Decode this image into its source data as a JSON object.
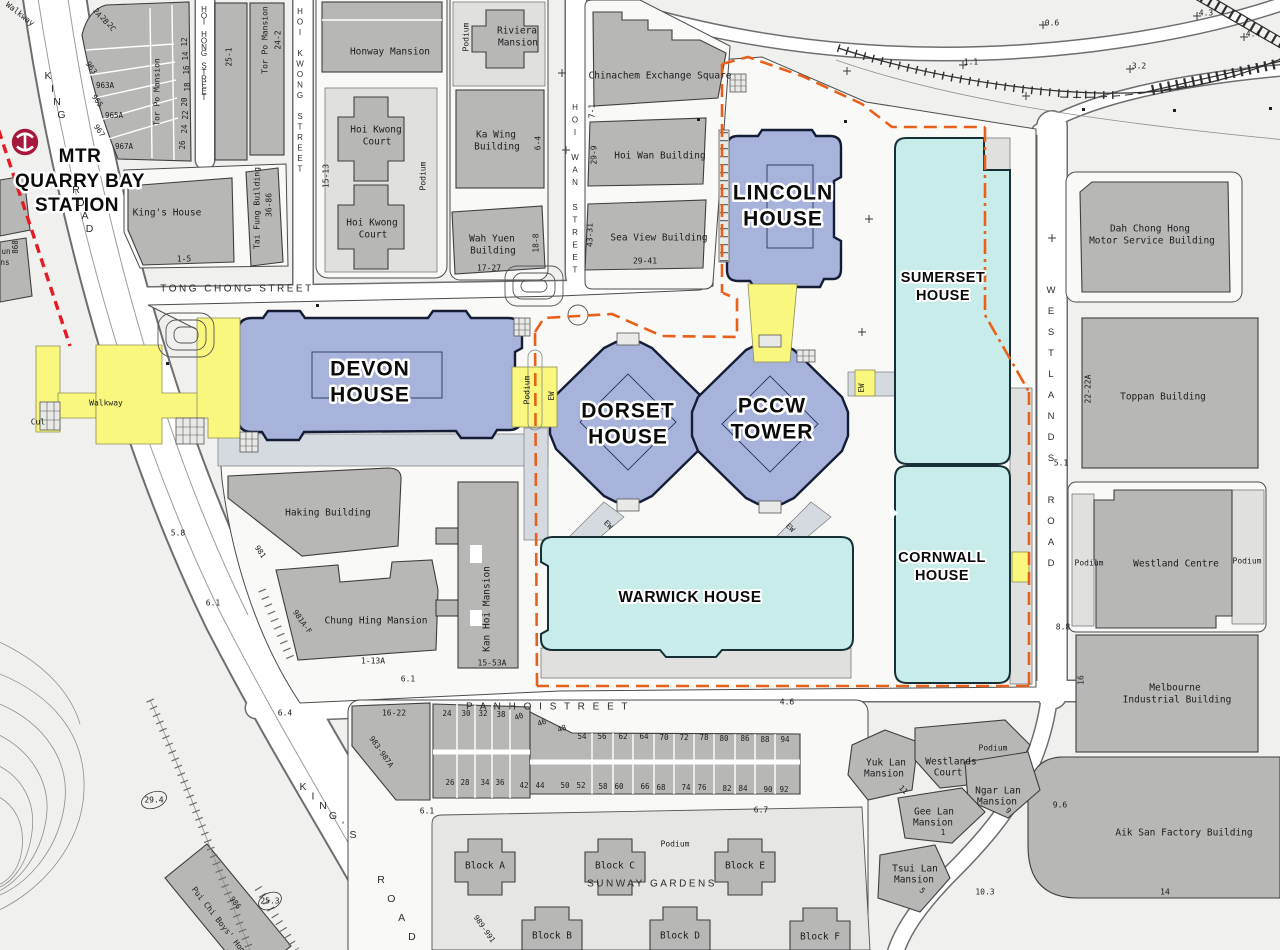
{
  "station": {
    "name": "MTR QUARRY BAY STATION",
    "logo": "mtr-logo"
  },
  "colors": {
    "office_blue": "#a7b3da",
    "tech_cyan": "#c7ecea",
    "walkway_yellow": "#f9f77d",
    "boundary_orange": "#e8611c",
    "mtr_red": "#e31b23",
    "mtr_logo": "#a6173c",
    "building_grey": "#b7b8b6"
  },
  "labels": {
    "station": [
      {
        "t": "MTR",
        "x": 80,
        "y": 157,
        "c": "station"
      },
      {
        "t": "QUARRY BAY",
        "x": 80,
        "y": 182,
        "c": "station"
      },
      {
        "t": "STATION",
        "x": 77,
        "y": 206,
        "c": "station"
      }
    ],
    "major_buildings": [
      {
        "t": "DEVON",
        "x": 370,
        "y": 370,
        "c": "halo1"
      },
      {
        "t": "HOUSE",
        "x": 370,
        "y": 396,
        "c": "halo1"
      },
      {
        "t": "DORSET",
        "x": 628,
        "y": 412,
        "c": "halo1"
      },
      {
        "t": "HOUSE",
        "x": 628,
        "y": 438,
        "c": "halo1"
      },
      {
        "t": "PCCW",
        "x": 772,
        "y": 407,
        "c": "halo1"
      },
      {
        "t": "TOWER",
        "x": 772,
        "y": 433,
        "c": "halo1"
      },
      {
        "t": "LINCOLN",
        "x": 783,
        "y": 194,
        "c": "halo1"
      },
      {
        "t": "HOUSE",
        "x": 783,
        "y": 220,
        "c": "halo1"
      },
      {
        "t": "SUMERSET",
        "x": 943,
        "y": 278,
        "c": "halo2"
      },
      {
        "t": "HOUSE",
        "x": 943,
        "y": 296,
        "c": "halo2"
      },
      {
        "t": "CORNWALL",
        "x": 942,
        "y": 558,
        "c": "halo2"
      },
      {
        "t": "HOUSE",
        "x": 942,
        "y": 576,
        "c": "halo2"
      },
      {
        "t": "WARWICK HOUSE",
        "x": 690,
        "y": 598,
        "c": "halo3"
      }
    ],
    "streets": [
      {
        "t": "TONG  CHONG  STREET",
        "x": 237,
        "y": 289,
        "c": "street"
      },
      {
        "t": "P A N    H O I    S T R E E T",
        "x": 548,
        "y": 707,
        "c": "street"
      },
      {
        "t": "SUNWAY  GARDENS",
        "x": 652,
        "y": 884,
        "c": "street"
      },
      {
        "t": "HOI HONG STREET",
        "x": 204,
        "y": 10,
        "c": "streetv",
        "v": 1,
        "lh": 6.3
      },
      {
        "t": "HOI KWONG STREET",
        "x": 300,
        "y": 12,
        "c": "streetv",
        "v": 1,
        "lh": 10.5
      },
      {
        "t": "HOI WAN STREET",
        "x": 575,
        "y": 108,
        "c": "streetv",
        "v": 1,
        "lh": 12.5
      },
      {
        "t": "WESTLANDS ROAD",
        "x": 1051,
        "y": 290,
        "c": "streetv2",
        "v": 1,
        "lh": 21
      },
      {
        "t": "KING",
        "x": 48,
        "y": 76,
        "c": "kings",
        "v": 1,
        "lh": 13,
        "sx": 4.5
      },
      {
        "t": "ROAD",
        "x": 76,
        "y": 190,
        "c": "kings",
        "v": 1,
        "lh": 13,
        "sx": 4.5
      },
      {
        "t": "KING'S",
        "x": 303,
        "y": 787,
        "c": "kings",
        "v": 1,
        "lh": 9.6,
        "sx": 10
      },
      {
        "t": "ROAD",
        "x": 381,
        "y": 880,
        "c": "kings",
        "v": 1,
        "lh": 19,
        "sx": 10.3
      }
    ],
    "buildings": [
      {
        "t": "Honway Mansion",
        "x": 390,
        "y": 52
      },
      {
        "t": "Riviera",
        "x": 517,
        "y": 31
      },
      {
        "t": "Mansion",
        "x": 518,
        "y": 43
      },
      {
        "t": "Podium",
        "x": 466,
        "y": 37,
        "r": -90,
        "c": "cadsm"
      },
      {
        "t": "Hoi Kwong",
        "x": 376,
        "y": 130
      },
      {
        "t": "Court",
        "x": 377,
        "y": 142
      },
      {
        "t": "Hoi Kwong",
        "x": 372,
        "y": 223
      },
      {
        "t": "Court",
        "x": 373,
        "y": 235
      },
      {
        "t": "15-13",
        "x": 326,
        "y": 176,
        "r": -90,
        "c": "cadsm"
      },
      {
        "t": "Podium",
        "x": 423,
        "y": 176,
        "r": -90,
        "c": "cadsm"
      },
      {
        "t": "Ka Wing",
        "x": 496,
        "y": 135
      },
      {
        "t": "Building",
        "x": 497,
        "y": 147
      },
      {
        "t": "6-4",
        "x": 538,
        "y": 143,
        "r": -90,
        "c": "cadsm"
      },
      {
        "t": "Wah Yuen",
        "x": 492,
        "y": 239
      },
      {
        "t": "Building",
        "x": 493,
        "y": 251
      },
      {
        "t": "17-27",
        "x": 489,
        "y": 268,
        "c": "cadsm"
      },
      {
        "t": "18-8",
        "x": 536,
        "y": 243,
        "r": -90,
        "c": "cadsm"
      },
      {
        "t": "Chinachem Exchange Square",
        "x": 660,
        "y": 76
      },
      {
        "t": "7-1",
        "x": 592,
        "y": 111,
        "r": -90,
        "c": "cadsm"
      },
      {
        "t": "Hoi Wan Building",
        "x": 660,
        "y": 156
      },
      {
        "t": "29-9",
        "x": 594,
        "y": 155,
        "r": -90,
        "c": "cadsm"
      },
      {
        "t": "Sea View Building",
        "x": 659,
        "y": 238
      },
      {
        "t": "29-41",
        "x": 645,
        "y": 261,
        "c": "cadsm"
      },
      {
        "t": "43-31",
        "x": 590,
        "y": 235,
        "r": -90,
        "c": "cadsm"
      },
      {
        "t": "Tor Po Mansion",
        "x": 157,
        "y": 92,
        "r": -90,
        "c": "cadsm"
      },
      {
        "t": "Tor Po Mansion",
        "x": 265,
        "y": 40,
        "r": -90,
        "c": "cadsm"
      },
      {
        "t": "24-2",
        "x": 278,
        "y": 40,
        "r": -90,
        "c": "cadsm"
      },
      {
        "t": "25-1",
        "x": 229,
        "y": 57,
        "r": -90,
        "c": "cadsm"
      },
      {
        "t": "King's House",
        "x": 167,
        "y": 213
      },
      {
        "t": "1-5",
        "x": 184,
        "y": 259,
        "c": "cadsm"
      },
      {
        "t": "Tai Fung Building",
        "x": 257,
        "y": 208,
        "r": -90,
        "c": "cadsm"
      },
      {
        "t": "36-86",
        "x": 269,
        "y": 205,
        "r": -90,
        "c": "cadsm"
      },
      {
        "t": "963",
        "x": 91,
        "y": 68,
        "r": 55,
        "c": "num"
      },
      {
        "t": "963A",
        "x": 105,
        "y": 86,
        "c": "num"
      },
      {
        "t": "965",
        "x": 97,
        "y": 101,
        "r": 55,
        "c": "num"
      },
      {
        "t": "965A",
        "x": 114,
        "y": 116,
        "c": "num"
      },
      {
        "t": "967",
        "x": 99,
        "y": 131,
        "r": 55,
        "c": "num"
      },
      {
        "t": "967A",
        "x": 124,
        "y": 147,
        "c": "num"
      },
      {
        "t": "2A",
        "x": 97,
        "y": 13,
        "r": 55,
        "c": "num"
      },
      {
        "t": "2B",
        "x": 104,
        "y": 20,
        "r": 55,
        "c": "num"
      },
      {
        "t": "2C",
        "x": 111,
        "y": 27,
        "r": 55,
        "c": "num"
      },
      {
        "t": "12",
        "x": 185,
        "y": 42,
        "r": -90,
        "c": "num"
      },
      {
        "t": "14",
        "x": 186,
        "y": 56,
        "r": -90,
        "c": "num"
      },
      {
        "t": "16",
        "x": 187,
        "y": 70,
        "r": -90,
        "c": "num"
      },
      {
        "t": "18",
        "x": 188,
        "y": 87,
        "r": -90,
        "c": "num"
      },
      {
        "t": "20",
        "x": 185,
        "y": 102,
        "r": -90,
        "c": "num"
      },
      {
        "t": "22",
        "x": 186,
        "y": 115,
        "r": -90,
        "c": "num"
      },
      {
        "t": "24",
        "x": 185,
        "y": 129,
        "r": -90,
        "c": "num"
      },
      {
        "t": "26",
        "x": 183,
        "y": 145,
        "r": -90,
        "c": "num"
      },
      {
        "t": "868",
        "x": 16,
        "y": 247,
        "r": -90,
        "c": "num"
      },
      {
        "t": "un",
        "x": 6,
        "y": 252,
        "c": "num"
      },
      {
        "t": "ns",
        "x": 5,
        "y": 263,
        "c": "num"
      },
      {
        "t": "Dah Chong Hong",
        "x": 1150,
        "y": 229
      },
      {
        "t": "Motor Service Building",
        "x": 1152,
        "y": 241
      },
      {
        "t": "Toppan Building",
        "x": 1163,
        "y": 397
      },
      {
        "t": "22-22A",
        "x": 1088,
        "y": 389,
        "r": -90,
        "c": "cadsm"
      },
      {
        "t": "Westland Centre",
        "x": 1176,
        "y": 564
      },
      {
        "t": "Podium",
        "x": 1089,
        "y": 563,
        "c": "cadsm"
      },
      {
        "t": "Podium",
        "x": 1247,
        "y": 561,
        "c": "cadsm"
      },
      {
        "t": "Melbourne",
        "x": 1175,
        "y": 688
      },
      {
        "t": "Industrial Building",
        "x": 1177,
        "y": 700
      },
      {
        "t": "16",
        "x": 1081,
        "y": 680,
        "r": -90,
        "c": "cadsm"
      },
      {
        "t": "Aik San Factory Building",
        "x": 1184,
        "y": 833
      },
      {
        "t": "14",
        "x": 1165,
        "y": 892,
        "c": "cadsm"
      },
      {
        "t": "Haking Building",
        "x": 328,
        "y": 513
      },
      {
        "t": "981",
        "x": 260,
        "y": 552,
        "r": 55,
        "c": "num"
      },
      {
        "t": "Chung Hing Mansion",
        "x": 376,
        "y": 621
      },
      {
        "t": "981A-F",
        "x": 302,
        "y": 622,
        "r": 55,
        "c": "num"
      },
      {
        "t": "1-13A",
        "x": 373,
        "y": 661,
        "c": "cadsm"
      },
      {
        "t": "Kan Hoi Mansion",
        "x": 487,
        "y": 609,
        "r": -90
      },
      {
        "t": "15-53A",
        "x": 492,
        "y": 663,
        "c": "cadsm"
      },
      {
        "t": "Yuk Lan",
        "x": 886,
        "y": 763
      },
      {
        "t": "Mansion",
        "x": 884,
        "y": 774
      },
      {
        "t": "Westlands",
        "x": 951,
        "y": 762
      },
      {
        "t": "Court",
        "x": 948,
        "y": 773
      },
      {
        "t": "Podium",
        "x": 993,
        "y": 748,
        "c": "cadsm"
      },
      {
        "t": "Ngar Lan",
        "x": 998,
        "y": 791
      },
      {
        "t": "Mansion",
        "x": 997,
        "y": 802
      },
      {
        "t": "Gee Lan",
        "x": 934,
        "y": 812
      },
      {
        "t": "Mansion",
        "x": 933,
        "y": 823
      },
      {
        "t": "Tsui Lan",
        "x": 915,
        "y": 869
      },
      {
        "t": "Mansion",
        "x": 914,
        "y": 880
      },
      {
        "t": "11",
        "x": 903,
        "y": 790,
        "r": 45,
        "c": "num"
      },
      {
        "t": "9",
        "x": 1008,
        "y": 811,
        "r": 45,
        "c": "num"
      },
      {
        "t": "1",
        "x": 943,
        "y": 833,
        "c": "num"
      },
      {
        "t": "5",
        "x": 922,
        "y": 891,
        "r": 45,
        "c": "num"
      },
      {
        "t": "Podium",
        "x": 675,
        "y": 844,
        "c": "cadsm"
      },
      {
        "t": "Block A",
        "x": 485,
        "y": 866
      },
      {
        "t": "Block C",
        "x": 615,
        "y": 866
      },
      {
        "t": "Block E",
        "x": 745,
        "y": 866
      },
      {
        "t": "Block B",
        "x": 552,
        "y": 936
      },
      {
        "t": "Block D",
        "x": 680,
        "y": 936
      },
      {
        "t": "Block F",
        "x": 820,
        "y": 937
      },
      {
        "t": "989-991",
        "x": 484,
        "y": 929,
        "r": 55,
        "c": "num"
      },
      {
        "t": "16-22",
        "x": 394,
        "y": 713,
        "c": "cadsm"
      },
      {
        "t": "983-987A",
        "x": 381,
        "y": 752,
        "r": 55,
        "c": "num"
      },
      {
        "t": "Pui Chi Boys' Home",
        "x": 220,
        "y": 922,
        "r": 52,
        "c": "cadsm"
      },
      {
        "t": "986",
        "x": 235,
        "y": 903,
        "r": 52,
        "c": "num"
      }
    ],
    "house_numbers": [
      {
        "t": "24",
        "x": 447,
        "y": 714,
        "c": "num"
      },
      {
        "t": "30",
        "x": 466,
        "y": 714,
        "c": "num"
      },
      {
        "t": "32",
        "x": 483,
        "y": 714,
        "c": "num"
      },
      {
        "t": "38",
        "x": 501,
        "y": 715,
        "c": "num"
      },
      {
        "t": "40",
        "x": 519,
        "y": 717,
        "r": -20,
        "c": "num"
      },
      {
        "t": "46",
        "x": 542,
        "y": 723,
        "r": -20,
        "c": "num"
      },
      {
        "t": "48",
        "x": 562,
        "y": 729,
        "r": -20,
        "c": "num"
      },
      {
        "t": "54",
        "x": 582,
        "y": 737,
        "c": "num"
      },
      {
        "t": "56",
        "x": 602,
        "y": 737,
        "c": "num"
      },
      {
        "t": "62",
        "x": 623,
        "y": 737,
        "c": "num"
      },
      {
        "t": "64",
        "x": 644,
        "y": 737,
        "c": "num"
      },
      {
        "t": "70",
        "x": 664,
        "y": 738,
        "c": "num"
      },
      {
        "t": "72",
        "x": 684,
        "y": 738,
        "c": "num"
      },
      {
        "t": "78",
        "x": 704,
        "y": 738,
        "c": "num"
      },
      {
        "t": "80",
        "x": 724,
        "y": 739,
        "c": "num"
      },
      {
        "t": "86",
        "x": 745,
        "y": 739,
        "c": "num"
      },
      {
        "t": "88",
        "x": 765,
        "y": 740,
        "c": "num"
      },
      {
        "t": "94",
        "x": 785,
        "y": 740,
        "c": "num"
      },
      {
        "t": "26",
        "x": 450,
        "y": 783,
        "c": "num"
      },
      {
        "t": "28",
        "x": 465,
        "y": 783,
        "c": "num"
      },
      {
        "t": "34",
        "x": 485,
        "y": 783,
        "c": "num"
      },
      {
        "t": "36",
        "x": 500,
        "y": 783,
        "c": "num"
      },
      {
        "t": "42",
        "x": 524,
        "y": 786,
        "c": "num"
      },
      {
        "t": "44",
        "x": 540,
        "y": 786,
        "c": "num"
      },
      {
        "t": "50",
        "x": 565,
        "y": 786,
        "c": "num"
      },
      {
        "t": "52",
        "x": 581,
        "y": 786,
        "c": "num"
      },
      {
        "t": "58",
        "x": 603,
        "y": 787,
        "c": "num"
      },
      {
        "t": "60",
        "x": 619,
        "y": 787,
        "c": "num"
      },
      {
        "t": "66",
        "x": 645,
        "y": 787,
        "c": "num"
      },
      {
        "t": "68",
        "x": 661,
        "y": 788,
        "c": "num"
      },
      {
        "t": "74",
        "x": 686,
        "y": 788,
        "c": "num"
      },
      {
        "t": "76",
        "x": 702,
        "y": 788,
        "c": "num"
      },
      {
        "t": "82",
        "x": 727,
        "y": 789,
        "c": "num"
      },
      {
        "t": "84",
        "x": 743,
        "y": 789,
        "c": "num"
      },
      {
        "t": "90",
        "x": 768,
        "y": 790,
        "c": "num"
      },
      {
        "t": "92",
        "x": 784,
        "y": 790,
        "c": "num"
      }
    ],
    "spot_heights": [
      {
        "t": "0.6",
        "x": 1052,
        "y": 23,
        "c": "cadsm"
      },
      {
        "t": "1.1",
        "x": 971,
        "y": 62,
        "c": "cadsm"
      },
      {
        "t": "3.2",
        "x": 1139,
        "y": 66,
        "c": "cadsm"
      },
      {
        "t": "4.4",
        "x": 1253,
        "y": 34,
        "c": "cadsm"
      },
      {
        "t": "4.3",
        "x": 1206,
        "y": 13,
        "c": "cadsm"
      },
      {
        "t": "5.1",
        "x": 1061,
        "y": 463,
        "c": "cadsm"
      },
      {
        "t": "8.8",
        "x": 1063,
        "y": 627,
        "c": "cadsm"
      },
      {
        "t": "9.6",
        "x": 1060,
        "y": 805,
        "c": "cadsm"
      },
      {
        "t": "6.1",
        "x": 408,
        "y": 679,
        "c": "cadsm"
      },
      {
        "t": "6.1",
        "x": 427,
        "y": 811,
        "c": "cadsm"
      },
      {
        "t": "6.7",
        "x": 761,
        "y": 810,
        "c": "cadsm"
      },
      {
        "t": "4.6",
        "x": 787,
        "y": 702,
        "c": "cadsm"
      },
      {
        "t": "6.4",
        "x": 285,
        "y": 713,
        "c": "cadsm"
      },
      {
        "t": "5.8",
        "x": 178,
        "y": 533,
        "c": "cadsm"
      },
      {
        "t": "6.1",
        "x": 213,
        "y": 603,
        "c": "cadsm"
      },
      {
        "t": "25.3",
        "x": 270,
        "y": 901,
        "c": "cadsm"
      },
      {
        "t": "29.4",
        "x": 154,
        "y": 800,
        "c": "cadsm"
      },
      {
        "t": "10.3",
        "x": 985,
        "y": 892,
        "c": "cadsm"
      }
    ],
    "walkways": [
      {
        "t": "Walkway",
        "x": 20,
        "y": 14,
        "r": 38,
        "c": "cadsm"
      },
      {
        "t": "Walkway",
        "x": 106,
        "y": 403,
        "c": "cadsm"
      },
      {
        "t": "Cul",
        "x": 38,
        "y": 422,
        "c": "cadsm"
      },
      {
        "t": "Podium",
        "x": 527,
        "y": 390,
        "r": -90,
        "c": "cadsm"
      },
      {
        "t": "EW",
        "x": 552,
        "y": 396,
        "r": -90,
        "c": "num"
      },
      {
        "t": "EW",
        "x": 862,
        "y": 388,
        "r": -90,
        "c": "num"
      },
      {
        "t": "EW",
        "x": 608,
        "y": 525,
        "r": 45,
        "c": "num"
      },
      {
        "t": "EW",
        "x": 790,
        "y": 528,
        "r": 45,
        "c": "num"
      }
    ]
  }
}
